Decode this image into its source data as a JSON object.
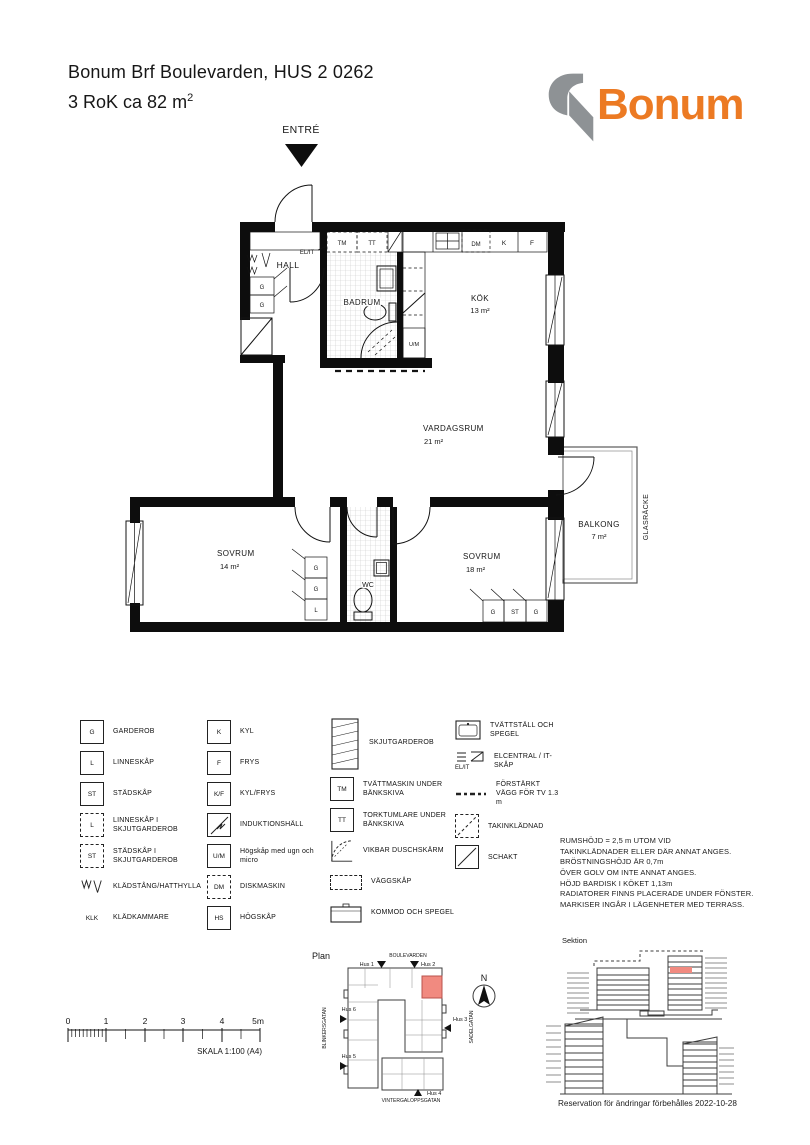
{
  "header": {
    "title": "Bonum Brf Boulevarden, HUS 2 0262",
    "subtitle": "3 RoK ca  82 m",
    "subtitle_sup": "2",
    "brand": "Bonum"
  },
  "floorplan": {
    "entry": "ENTRÉ",
    "rooms": {
      "hall": "HALL",
      "badrum": "BADRUM",
      "kok": "KÖK",
      "kok_area": "13 m²",
      "vardagsrum": "VARDAGSRUM",
      "vardagsrum_area": "21 m²",
      "sovrum1": "SOVRUM",
      "sovrum1_area": "14 m²",
      "sovrum2": "SOVRUM",
      "sovrum2_area": "18 m²",
      "wc": "WC",
      "balkong": "BALKONG",
      "balkong_area": "7 m²",
      "glasracke": "GLASRÄCKE"
    },
    "marks": {
      "elit": "EL/IT",
      "tm": "TM",
      "tt": "TT",
      "dm": "DM",
      "k": "K",
      "f": "F",
      "um": "U/M",
      "g": "G",
      "l": "L",
      "st": "ST"
    }
  },
  "legend": {
    "col1": [
      {
        "sym": "G",
        "label": "GARDEROB"
      },
      {
        "sym": "L",
        "label": "LINNESKÅP"
      },
      {
        "sym": "ST",
        "label": "STÄDSKÅP"
      },
      {
        "sym": "L",
        "label": "LINNESKÅP I SKJUTGARDEROB"
      },
      {
        "sym": "ST",
        "label": "STÄDSKÅP I SKJUTGARDEROB"
      },
      {
        "sym": "",
        "label": "KLÄDSTÅNG/HATTHYLLA"
      },
      {
        "sym": "KLK",
        "label": "KLÄDKAMMARE"
      }
    ],
    "col2": [
      {
        "sym": "K",
        "label": "KYL"
      },
      {
        "sym": "F",
        "label": "FRYS"
      },
      {
        "sym": "K/F",
        "label": "KYL/FRYS"
      },
      {
        "sym": "",
        "label": "INDUKTIONSHÄLL"
      },
      {
        "sym": "U/M",
        "label": "Högskåp med ugn och micro"
      },
      {
        "sym": "DM",
        "label": "DISKMASKIN"
      },
      {
        "sym": "HS",
        "label": "HÖGSKÅP"
      }
    ],
    "col3": [
      {
        "sym": "",
        "label": "SKJUTGARDEROB"
      },
      {
        "sym": "TM",
        "label": "TVÄTTMASKIN UNDER BÄNKSKIVA"
      },
      {
        "sym": "TT",
        "label": "TORKTUMLARE UNDER BÄNKSKIVA"
      },
      {
        "sym": "",
        "label": "VIKBAR DUSCHSKÄRM"
      },
      {
        "sym": "",
        "label": "VÄGGSKÅP"
      },
      {
        "sym": "",
        "label": "KOMMOD OCH SPEGEL"
      }
    ],
    "col4": [
      {
        "sym": "",
        "label": "TVÄTTSTÄLL OCH SPEGEL"
      },
      {
        "sym": "EL/IT",
        "label": "ELCENTRAL / IT-SKÅP"
      },
      {
        "sym": "",
        "label": "FÖRSTÄRKT VÄGG FÖR TV 1.3 m"
      },
      {
        "sym": "",
        "label": "TAKINKLÄDNAD"
      },
      {
        "sym": "",
        "label": "SCHAKT"
      }
    ]
  },
  "notes": {
    "lines": [
      "RUMSHÖJD = 2,5 m UTOM VID",
      "TAKINKLÄDNADER ELLER DÄR ANNAT ANGES.",
      "BRÖSTNINGSHÖJD ÄR  0,7m",
      "ÖVER GOLV OM INTE ANNAT ANGES.",
      "HÖJD BARDISK I KÖKET 1,13m",
      "RADIATORER FINNS PLACERADE UNDER FÖNSTER.",
      "MARKISER INGÅR I LÄGENHETER MED TERRASS."
    ]
  },
  "scalebar": {
    "ticks": [
      "0",
      "1",
      "2",
      "3",
      "4",
      "5m"
    ],
    "caption": "SKALA 1:100 (A4)"
  },
  "siteplan": {
    "title": "Plan",
    "streets": {
      "top": "BOULEVARDEN",
      "left": "BLINKERSGATAN",
      "right": "SADELGATAN",
      "bottom": "VINTERGALOPPSGATAN"
    },
    "buildings": {
      "hus1": "Hus 1",
      "hus2": "Hus 2",
      "hus3": "Hus 3",
      "hus4": "Hus 4",
      "hus5": "Hus 5",
      "hus6": "Hus 6"
    },
    "north": "N"
  },
  "sektion": {
    "title": "Sektion"
  },
  "footer": {
    "reservation": "Reservation för ändringar förbehålles 2022-10-28"
  },
  "colors": {
    "brand_orange": "#EC7A23",
    "logo_gray": "#8E9295",
    "unit_highlight": "#F18A80"
  }
}
